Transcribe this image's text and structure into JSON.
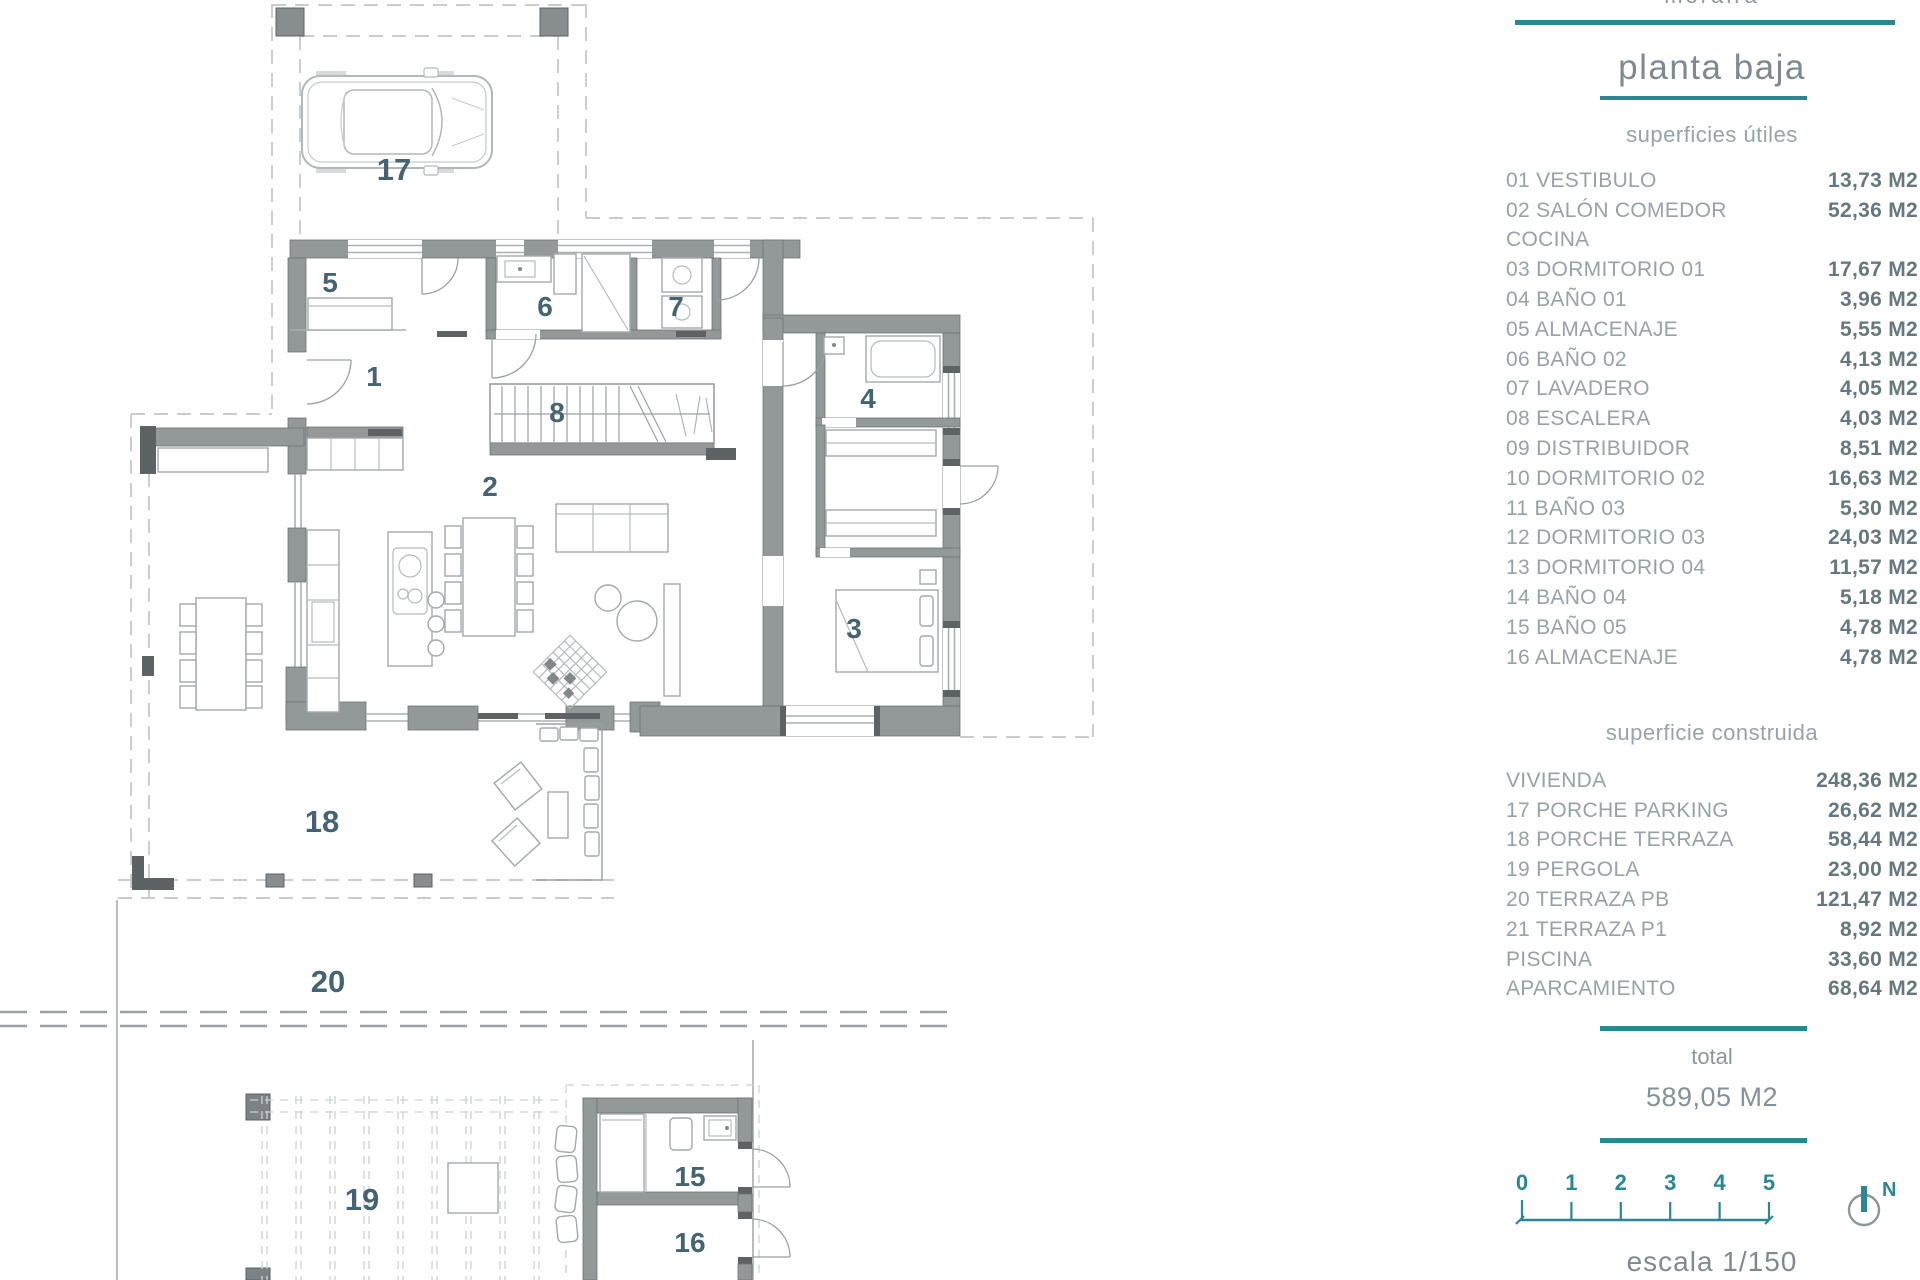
{
  "panel": {
    "project": "moraira",
    "title": "planta baja",
    "useful_areas": {
      "heading": "superficies útiles",
      "rows": [
        {
          "label": "01 VESTIBULO",
          "value": "13,73 M2"
        },
        {
          "label": "02 SALÓN COMEDOR",
          "value": "52,36 M2"
        },
        {
          "label": "COCINA",
          "value": ""
        },
        {
          "label": "03 DORMITORIO 01",
          "value": "17,67 M2"
        },
        {
          "label": "04 BAÑO 01",
          "value": "3,96 M2"
        },
        {
          "label": "05 ALMACENAJE",
          "value": "5,55 M2"
        },
        {
          "label": "06 BAÑO 02",
          "value": "4,13 M2"
        },
        {
          "label": "07 LAVADERO",
          "value": "4,05 M2"
        },
        {
          "label": "08 ESCALERA",
          "value": "4,03 M2"
        },
        {
          "label": "09 DISTRIBUIDOR",
          "value": "8,51 M2"
        },
        {
          "label": "10 DORMITORIO 02",
          "value": "16,63 M2"
        },
        {
          "label": "11 BAÑO 03",
          "value": "5,30 M2"
        },
        {
          "label": "12 DORMITORIO 03",
          "value": "24,03 M2"
        },
        {
          "label": "13 DORMITORIO 04",
          "value": "11,57 M2"
        },
        {
          "label": "14 BAÑO 04",
          "value": "5,18 M2"
        },
        {
          "label": "15 BAÑO 05",
          "value": "4,78 M2"
        },
        {
          "label": "16 ALMACENAJE",
          "value": "4,78 M2"
        }
      ]
    },
    "built_areas": {
      "heading": "superficie construida",
      "rows": [
        {
          "label": "VIVIENDA",
          "value": "248,36 M2"
        },
        {
          "label": "17 PORCHE PARKING",
          "value": "26,62 M2"
        },
        {
          "label": "18 PORCHE TERRAZA",
          "value": "58,44 M2"
        },
        {
          "label": "19 PERGOLA",
          "value": "23,00 M2"
        },
        {
          "label": "20 TERRAZA PB",
          "value": "121,47 M2"
        },
        {
          "label": "21 TERRAZA P1",
          "value": "8,92 M2"
        },
        {
          "label": "PISCINA",
          "value": "33,60 M2"
        },
        {
          "label": "APARCAMIENTO",
          "value": "68,64 M2"
        }
      ]
    },
    "total": {
      "label": "total",
      "value": "589,05 M2"
    },
    "scale_bar": {
      "ticks": [
        "0",
        "1",
        "2",
        "3",
        "4",
        "5"
      ],
      "compass": "N",
      "caption": "escala 1/150"
    }
  },
  "plan": {
    "room_labels": {
      "n1": "1",
      "n2": "2",
      "n3": "3",
      "n4": "4",
      "n5": "5",
      "n6": "6",
      "n7": "7",
      "n8": "8",
      "n15": "15",
      "n16": "16",
      "n17": "17",
      "n18": "18",
      "n19": "19",
      "n20": "20"
    }
  },
  "colors": {
    "accent": "#2b8794",
    "wall": "#939899",
    "room_number": "#456471"
  }
}
